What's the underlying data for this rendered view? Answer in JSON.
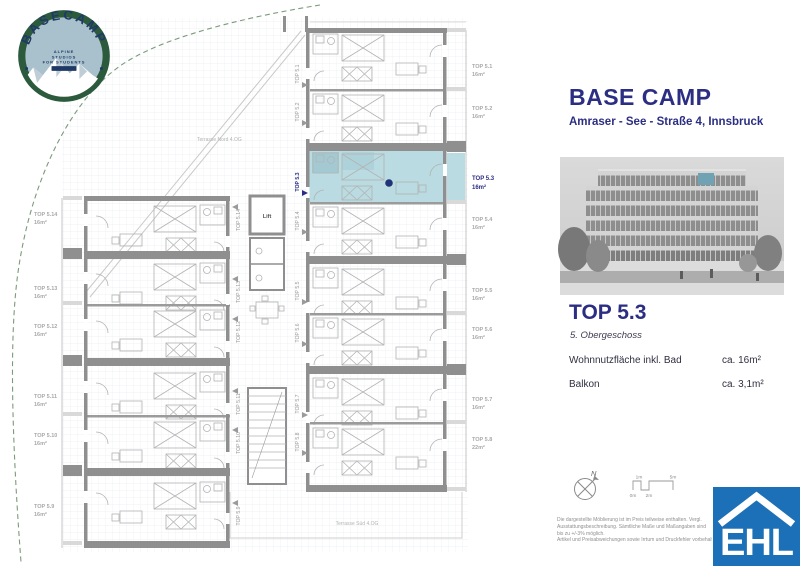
{
  "brand_logo": {
    "name": "BASECAMP",
    "tagline1": "ALPINE",
    "tagline2": "STUDIOS",
    "tagline3": "FOR STUDENTS"
  },
  "header": {
    "title": "BASE CAMP",
    "address": "Amraser - See - Straße 4, Innsbruck"
  },
  "unit_details": {
    "title": "TOP 5.3",
    "floor": "5. Obergeschoss",
    "area_label": "Wohnnutzfläche inkl. Bad",
    "area_value": "ca. 16m²",
    "balcony_label": "Balkon",
    "balcony_value": "ca.  3,1m²"
  },
  "floor_plan": {
    "terrace_north": "Terrasse Nord 4.OG",
    "terrace_south": "Terrasse Süd 4.OG",
    "lift": "Lift",
    "highlighted_unit": "TOP 5.3",
    "highlight_color": "#b9dbe1",
    "units_right": [
      {
        "name": "TOP 5.1",
        "area": "16m²"
      },
      {
        "name": "TOP 5.2",
        "area": "16m²"
      },
      {
        "name": "TOP 5.3",
        "area": "16m²"
      },
      {
        "name": "TOP 5.4",
        "area": "16m²"
      },
      {
        "name": "TOP 5.5",
        "area": "16m²"
      },
      {
        "name": "TOP 5.6",
        "area": "16m²"
      },
      {
        "name": "TOP 5.7",
        "area": "16m²"
      },
      {
        "name": "TOP 5.8",
        "area": "22m²"
      }
    ],
    "units_left": [
      {
        "name": "TOP 5.14",
        "area": "16m²"
      },
      {
        "name": "TOP 5.13",
        "area": "16m²"
      },
      {
        "name": "TOP 5.12",
        "area": "16m²"
      },
      {
        "name": "TOP 5.11",
        "area": "16m²"
      },
      {
        "name": "TOP 5.10",
        "area": "16m²"
      },
      {
        "name": "TOP 5.9",
        "area": "16m²"
      }
    ]
  },
  "compass": {
    "north": "N"
  },
  "scale_bar": {
    "t1": "1m",
    "t5": "5m",
    "b0": "0m",
    "b2": "2m"
  },
  "disclaimer": [
    "Die dargestellte Möblierung ist im Preis teilweise enthalten. Vergl.",
    "Ausstattungsbeschreibung. Sämtliche Maße und Maßangaben sind",
    "bis zu +/-3% möglich.",
    "Artikel und Preisabweichungen sowie Irrtum und Druckfehler vorbehalten."
  ],
  "ehl_logo": {
    "text": "EHL"
  },
  "colors": {
    "navy": "#2b2e83",
    "ehl_blue": "#1c70b7",
    "logo_green": "#2c5a3d",
    "highlight": "#b9dbe1"
  }
}
